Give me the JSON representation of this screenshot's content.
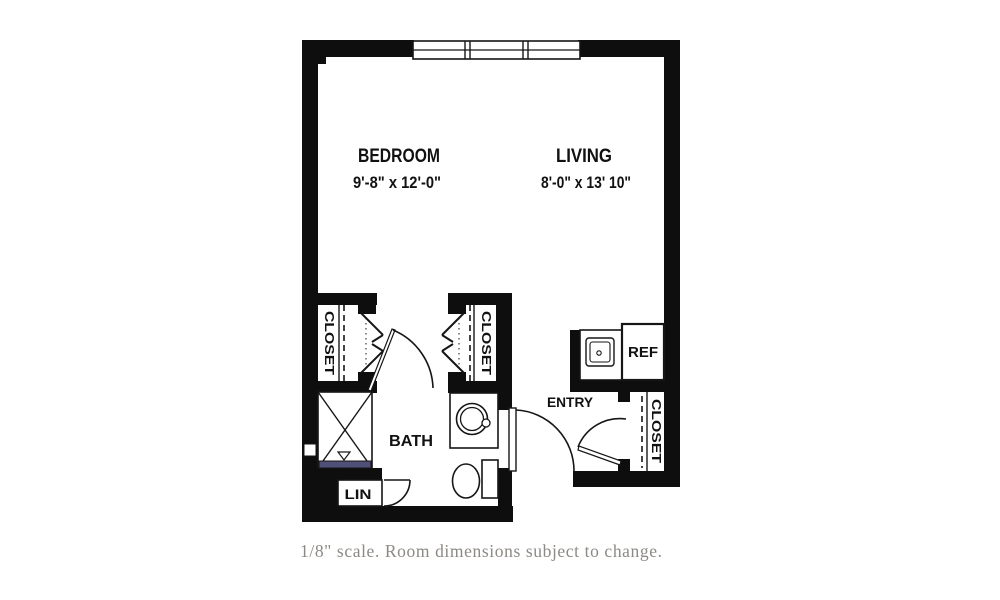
{
  "plan": {
    "bedroom": {
      "label": "BEDROOM",
      "dims": "9'-8\" x 12'-0\""
    },
    "living": {
      "label": "LIVING",
      "dims": "8'-0\" x 13' 10\""
    },
    "bath": {
      "label": "BATH"
    },
    "entry": {
      "label": "ENTRY"
    },
    "closets": {
      "left": "CLOSET",
      "middle": "CLOSET",
      "entry": "CLOSET"
    },
    "linen": {
      "label": "LIN"
    },
    "kitchenette": {
      "ref_label": "REF"
    },
    "colors": {
      "wall": "#0e0e0e",
      "line": "#161616",
      "shower_threshold": "#4f4f78",
      "caption_text": "#8d8a85",
      "background": "#ffffff"
    }
  },
  "caption": {
    "text": "1/8\" scale. Room dimensions subject to change."
  }
}
